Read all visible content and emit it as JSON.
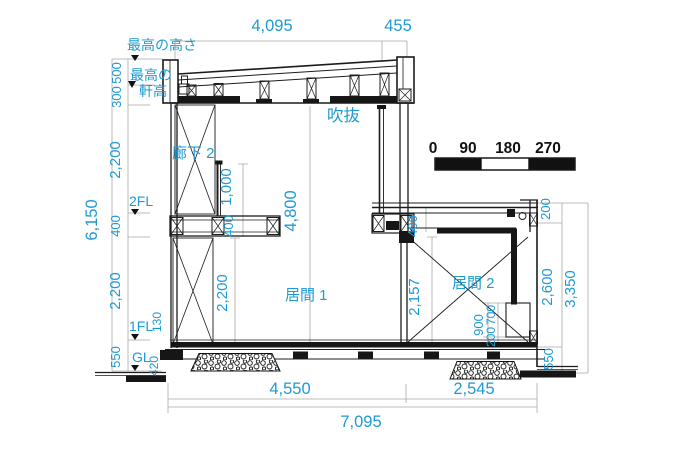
{
  "colors": {
    "dimension_text": "#1f9ad3",
    "line_ink": "#1c1c1c"
  },
  "levels": {
    "max_height": "最高の高さ",
    "max_eave_1": "最高の",
    "max_eave_2": "軒高",
    "fl2": "2FL",
    "fl1": "1FL",
    "gl": "GL"
  },
  "rooms": {
    "corridor": "廊下 2",
    "void_space": "吹抜",
    "living1": "居間 1",
    "living2": "居間 2"
  },
  "dims": {
    "roof_span": "4,095",
    "roof_overhang": "455",
    "parapet_h": "500",
    "roof_h": "300",
    "fl2_ceiling_h": "2,200",
    "floor_depth": "400",
    "fl1_ceiling_h": "2,200",
    "base_h": "550",
    "total_h": "6,150",
    "railing_h": "1,000",
    "railing_base": "400",
    "living1_wall_h": "2,200",
    "void_h": "4,800",
    "living2_ceiling_h": "2,157",
    "roof2_depth": "400",
    "sill_total": "900",
    "sill_upper": "700",
    "sill_lower": "200",
    "floor_edge": "130",
    "foundation_h": "420",
    "parapet2_h": "200",
    "living2_h": "2,600",
    "base2_h": "550",
    "total2_h": "3,350",
    "span_living1": "4,550",
    "span_living2": "2,545",
    "span_total": "7,095"
  },
  "scale": {
    "ticks": [
      "0",
      "90",
      "180",
      "270"
    ]
  }
}
